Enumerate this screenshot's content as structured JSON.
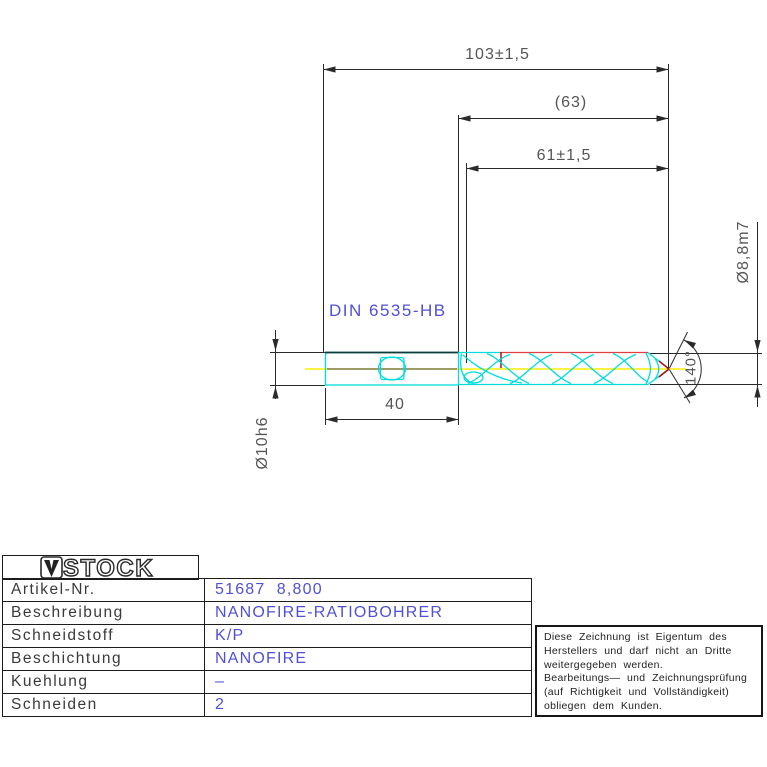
{
  "drawing": {
    "din_label": "DIN 6535-HB",
    "dimensions": {
      "overall_length": "103±1,5",
      "flute_ref_length": "(63)",
      "flute_length": "61±1,5",
      "shank_length": "40",
      "point_angle": "140°",
      "drill_diameter": "Ø8,8m7",
      "shank_diameter": "Ø10h6"
    }
  },
  "title_block": {
    "logo_text": "STOCK",
    "rows": [
      {
        "label": "Artikel-Nr.",
        "value": "51687  8,800"
      },
      {
        "label": "Beschreibung",
        "value": "NANOFIRE-RATIOBOHRER"
      },
      {
        "label": "Schneidstoff",
        "value": "K/P"
      },
      {
        "label": "Beschichtung",
        "value": "NANOFIRE"
      },
      {
        "label": "Kuehlung",
        "value": "–"
      },
      {
        "label": "Schneiden",
        "value": "2"
      }
    ]
  },
  "disclaimer": {
    "lines": [
      "Diese Zeichnung ist Eigentum des",
      "Herstellers und darf nicht an Dritte",
      "weitergegeben werden.",
      "Bearbeitungs— und Zeichnungsprüfung",
      "(auf Richtigkeit und Vollständigkeit)",
      "obliegen dem Kunden."
    ]
  },
  "colors": {
    "line": "#2a2a2a",
    "dim_text": "#555555",
    "blue_text": "#5050d7",
    "cyan": "#00dcdc",
    "dark_edge": "#0b3b3b",
    "red": "#e04040",
    "dark_red": "#b01010",
    "yellow": "#ffee00",
    "olive": "#8f8f60"
  }
}
